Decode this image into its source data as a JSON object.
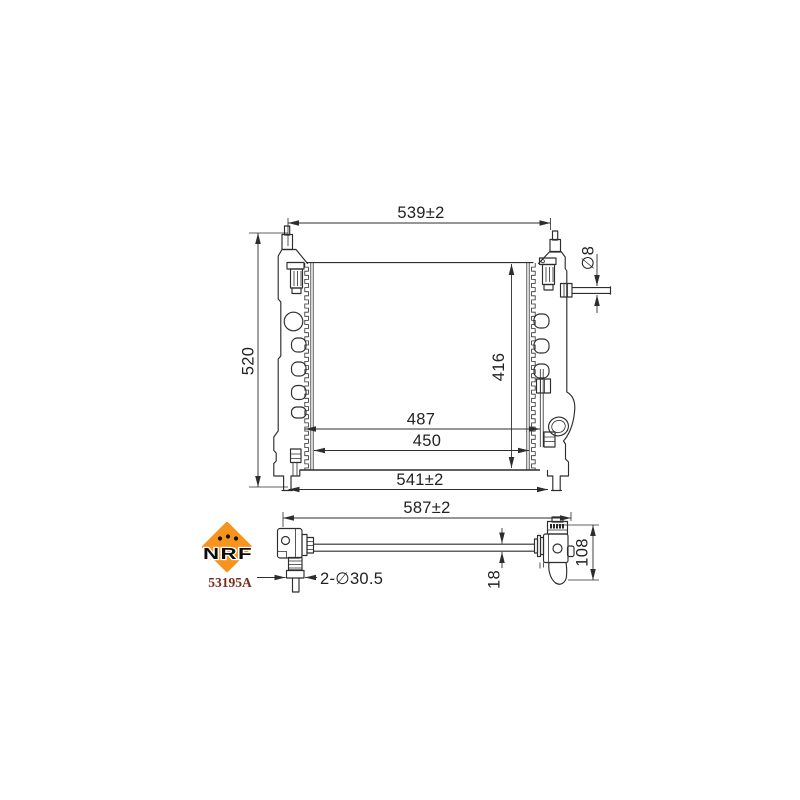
{
  "drawing": {
    "line_color": "#2d2d2d",
    "dimensions": {
      "top_width": "539±2",
      "overall_height": "520",
      "inlet_pipe_diameter": "∅8",
      "core_height": "416",
      "inner_width_upper": "487",
      "inner_width_lower": "450",
      "bottom_width": "541±2",
      "total_width": "587±2",
      "mounting_hole": "2-∅30.5",
      "core_thickness": "18",
      "tank_depth": "108"
    },
    "brand": {
      "logo_text": "NRF",
      "part_number": "53195A",
      "logo_color": "#F7941E",
      "logo_text_color": "#0d0d0d",
      "part_number_color": "#7b2b1c"
    }
  }
}
